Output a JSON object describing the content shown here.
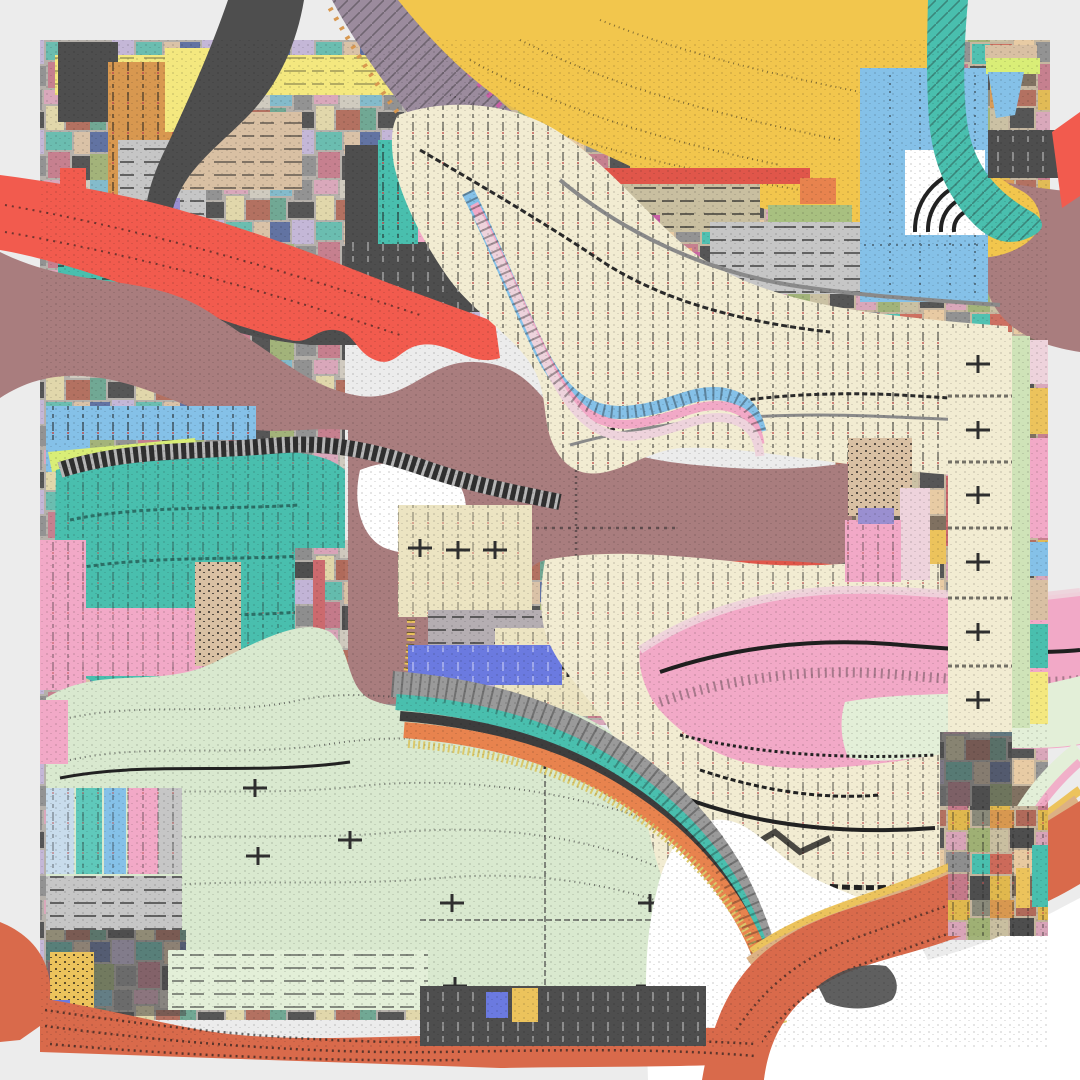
{
  "meta": {
    "kind": "abstract-glitch-composition",
    "width": 1080,
    "height": 1080,
    "description": "Heavily glitched square collage: pixel-smeared mosaic blocks and flowing wavy ribbon bands with stipple/comb textures. No text, no UI controls."
  },
  "palette": {
    "bg": "#ececec",
    "white": "#ffffff",
    "gold": "#f2c64d",
    "paleYellow": "#f4e87f",
    "chartreuse": "#d9ee77",
    "khaki": "#c9bfa0",
    "cream": "#f2ecd2",
    "beige": "#ece4c2",
    "tan": "#d9c0a3",
    "sand": "#dcb184",
    "grayLight": "#c6c6c6",
    "gray": "#9b9b9b",
    "grayMid": "#b5aeb2",
    "charcoal": "#4e4e4e",
    "rose": "#a97d7e",
    "red": "#f25b4e",
    "redDeep": "#e0564a",
    "orangeRed": "#d96a4b",
    "orange": "#e8834e",
    "salmon": "#f0a070",
    "goldDark": "#d89850",
    "yellowAccent": "#ecc35c",
    "teal": "#49bfae",
    "tealLight": "#5fc9bb",
    "skyBlue": "#85c1e8",
    "paleBlue": "#c8dcec",
    "blue": "#6b7ae0",
    "lilac": "#9a8fd0",
    "mint": "#d9e9cf",
    "paleGreen": "#e3efd8",
    "greenBorder": "#cfe3b8",
    "olive": "#a8c080",
    "pink": "#f2a9c7",
    "palePink": "#eed3dc",
    "hotPink": "#ee3f9a",
    "magenta": "#c75fa5",
    "mauve": "#9b8b9d",
    "roseRed": "#cc6a6e"
  },
  "regions": [
    {
      "name": "dusty-rose-central-mass",
      "color": "rose",
      "note": "large smooth blob spanning left edge to x~850, y~250-700, with faint smeared crosshair"
    },
    {
      "name": "gold-blob-top",
      "color": "gold",
      "note": "wavy golden mass across top center-right with dotted smear lines"
    },
    {
      "name": "red-wavy-band-left",
      "color": "red",
      "note": "diagonal wavy band from left edge down-right with stipple rows"
    },
    {
      "name": "cream-comb-ribbon",
      "color": "cream",
      "note": "S-shaped ribbon with vertical tick comb texture and dark wavy strata, edged by sky-blue/pink chevron stripes"
    },
    {
      "name": "teal-mass-mid-left",
      "color": "teal",
      "note": "wavy teal field with dark strata and zebra striped upper edge"
    },
    {
      "name": "mint-field-bottom-left",
      "color": "mint",
      "note": "large pale green field with dotted contour waves and grid crosses"
    },
    {
      "name": "pink-wave-band-right",
      "color": "pink",
      "note": "thick wavy pink band with black centerline and comb fringe"
    },
    {
      "name": "cream-mass-bottom-right",
      "color": "cream",
      "note": "beige field with heavy black smear strata"
    },
    {
      "name": "orange-s-curve-bottom-right",
      "color": "orangeRed",
      "note": "sweeping orange band stacked with charcoal, sand and gold stripes"
    },
    {
      "name": "multicolor-highway",
      "color": "teal",
      "note": "parallel gray/teal/charcoal/orange/gold bands sweeping from center to bottom right"
    },
    {
      "name": "blue-panel-top-right",
      "color": "skyBlue",
      "note": "rectangular sky blue panel with seams and a zebra arc fan"
    },
    {
      "name": "teal-chevron-band-top-right",
      "color": "teal",
      "note": "hatched diagonal band from top edge toward right edge"
    },
    {
      "name": "purple-chevron-band-top-left",
      "color": "mauve",
      "note": "diagonal band with magenta and gold speck fringes"
    },
    {
      "name": "dark-diagonal-band-top-left",
      "color": "charcoal",
      "note": "charcoal band curving from top edge into comb-toothed mass"
    },
    {
      "name": "mosaic-clusters",
      "color": "gray",
      "note": "dense multicolored small-block mosaics in top-left, mid-left, bottom-left, center and right columns"
    },
    {
      "name": "beige-grid-panels",
      "color": "beige",
      "note": "panels with plus-shaped survey marks and seam lines, center and right column"
    },
    {
      "name": "hot-pink-block",
      "color": "hotPink",
      "note": "saturated pink block with plus marks, mid-left"
    },
    {
      "name": "indigo-bar",
      "color": "blue",
      "note": "horizontal blue bar with white dashes, center"
    },
    {
      "name": "white-wave-blobs",
      "color": "white",
      "note": "soft white voids at bottom center and bottom right"
    },
    {
      "name": "orange-stripe-bottom-edge",
      "color": "orangeRed",
      "note": "wavy stippled stripes along the bottom collage edge"
    }
  ]
}
